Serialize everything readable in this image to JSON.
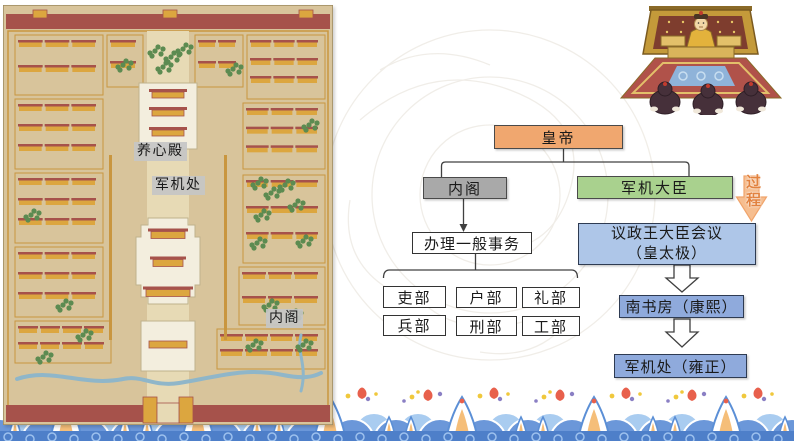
{
  "map": {
    "labels": [
      {
        "id": "yangxindian",
        "text": "养心殿"
      },
      {
        "id": "junjichu",
        "text": "军机处"
      },
      {
        "id": "neige",
        "text": "内阁"
      }
    ]
  },
  "icons": {
    "illustration": "emperor-court-audience-cartoon",
    "process_arrow": "orange-down-block-arrow",
    "flow_arrow": "hollow-down-arrow",
    "bottom_border": "chinese-wave-pattern",
    "background": "faint-dragon-watermark"
  },
  "flowchart": {
    "nodes": {
      "emperor": {
        "label": "皇帝",
        "fill": "#F0A76F"
      },
      "cabinet": {
        "label": "内阁",
        "fill": "#A9A9A9"
      },
      "grand_ministers": {
        "label": "军机大臣",
        "fill": "#A9D18E"
      },
      "general_affairs": {
        "label": "办理一般事务",
        "fill": "#FFFFFF"
      }
    },
    "ministries": [
      "吏部",
      "户部",
      "礼部",
      "兵部",
      "刑部",
      "工部"
    ],
    "process_label": "过程",
    "evolution": [
      {
        "line1": "议政王大臣会议",
        "line2": "（皇太极）",
        "fill": "#AEC6E8"
      },
      {
        "line1": "南书房（康熙）",
        "line2": "",
        "fill": "#8FAADC"
      },
      {
        "line1": "军机处（雍正）",
        "line2": "",
        "fill": "#8FAADC"
      }
    ]
  },
  "colors": {
    "wave_blue": "#6B97D9",
    "wave_dark_blue": "#4E7FC9",
    "wave_purple": "#8487CB",
    "wave_orange": "#F5BE79",
    "map_wall_red": "#A6524B",
    "map_gold": "#DCA63F",
    "map_background": "#D8C49B"
  }
}
